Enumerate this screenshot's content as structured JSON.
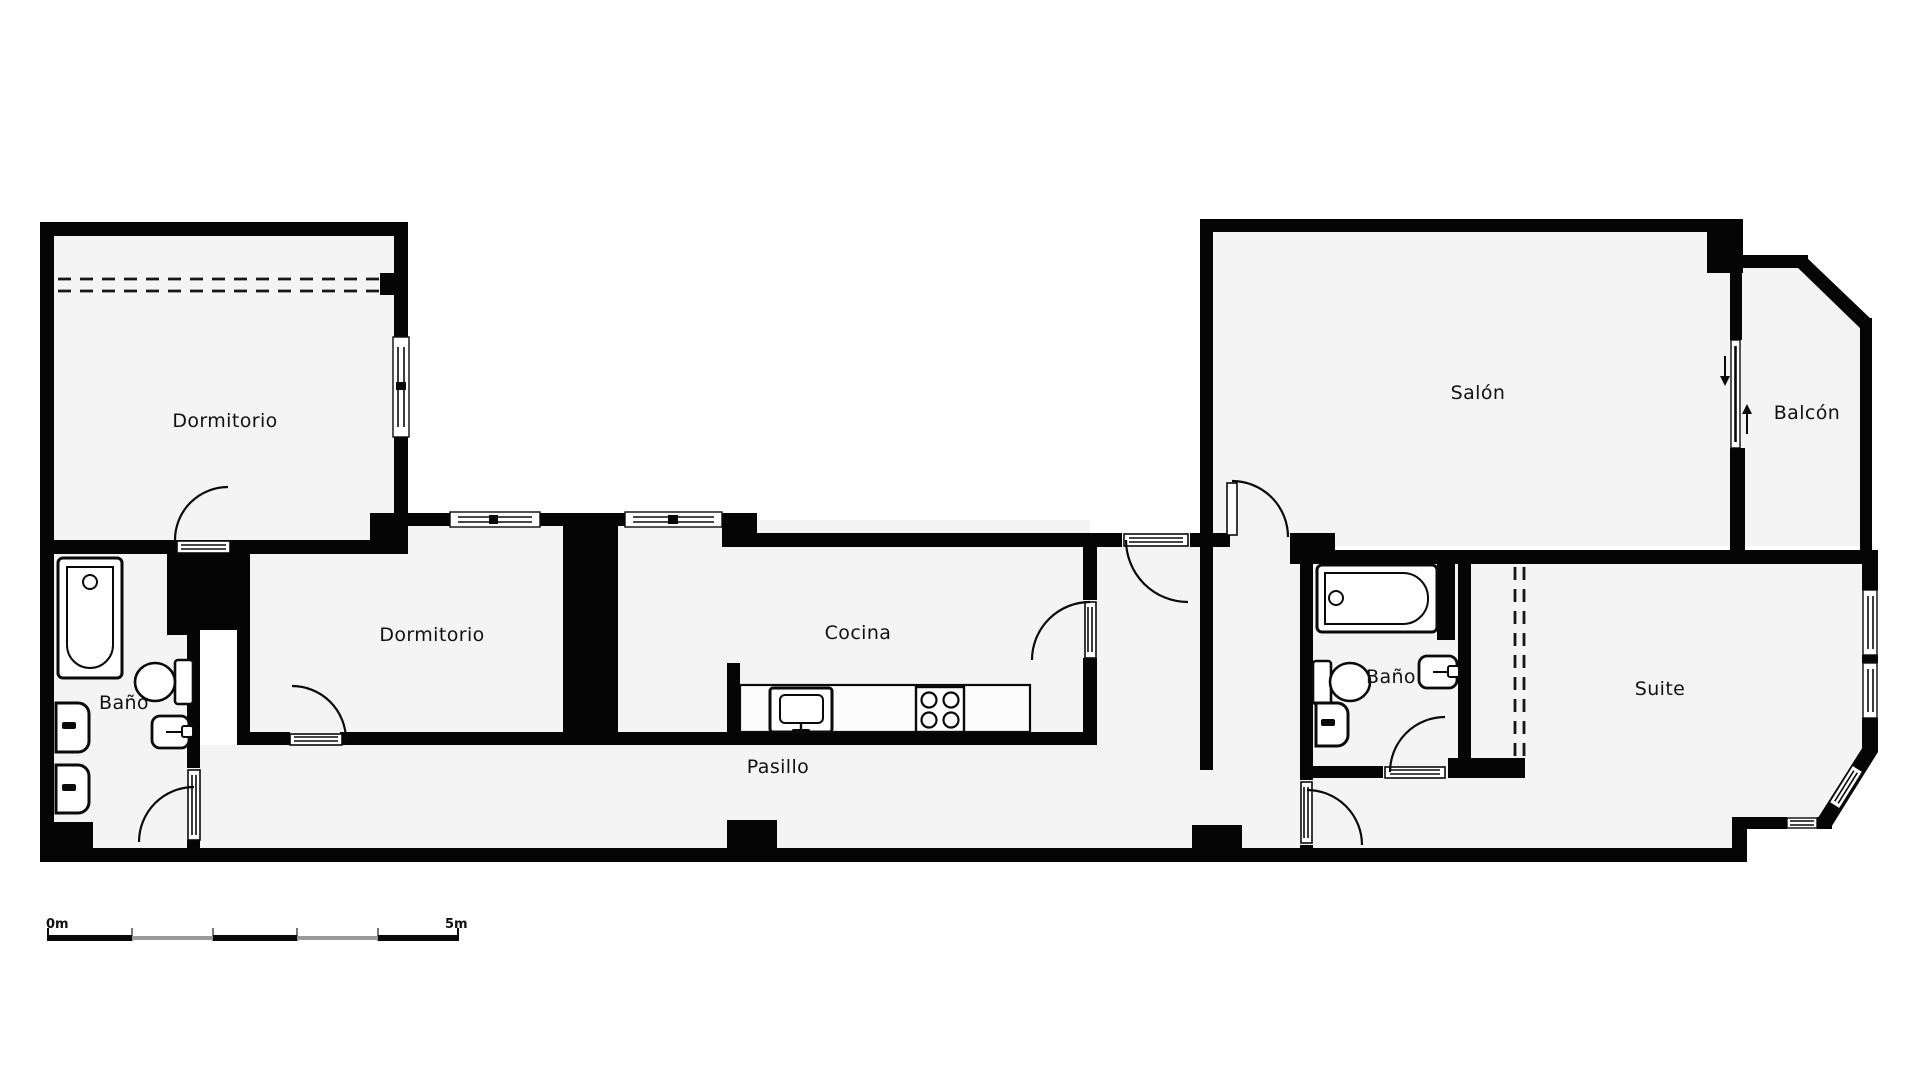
{
  "floorplan": {
    "title": "apartment-floor-plan",
    "rooms": [
      {
        "id": "dormitorio-1",
        "label": "Dormitorio"
      },
      {
        "id": "bano-1",
        "label": "Baño"
      },
      {
        "id": "dormitorio-2",
        "label": "Dormitorio"
      },
      {
        "id": "cocina",
        "label": "Cocina"
      },
      {
        "id": "pasillo",
        "label": "Pasillo"
      },
      {
        "id": "salon",
        "label": "Salón"
      },
      {
        "id": "balcon",
        "label": "Balcón"
      },
      {
        "id": "bano-2",
        "label": "Baño"
      },
      {
        "id": "suite",
        "label": "Suite"
      }
    ],
    "fixtures": [
      "bathtub-icon",
      "toilet-icon",
      "washbasin-icon",
      "bidet-icon",
      "kitchen-sink-icon",
      "stove-icon",
      "door-swing-icon",
      "window-icon",
      "sliding-door-arrow-icon",
      "closet-dashed-line"
    ],
    "scale_bar": {
      "start_label": "0m",
      "end_label": "5m",
      "segments": 5
    },
    "colors": {
      "wall": "#050505",
      "floor": "#f4f4f4",
      "background": "#ffffff",
      "scale_alt": "#9a9a9a"
    }
  }
}
